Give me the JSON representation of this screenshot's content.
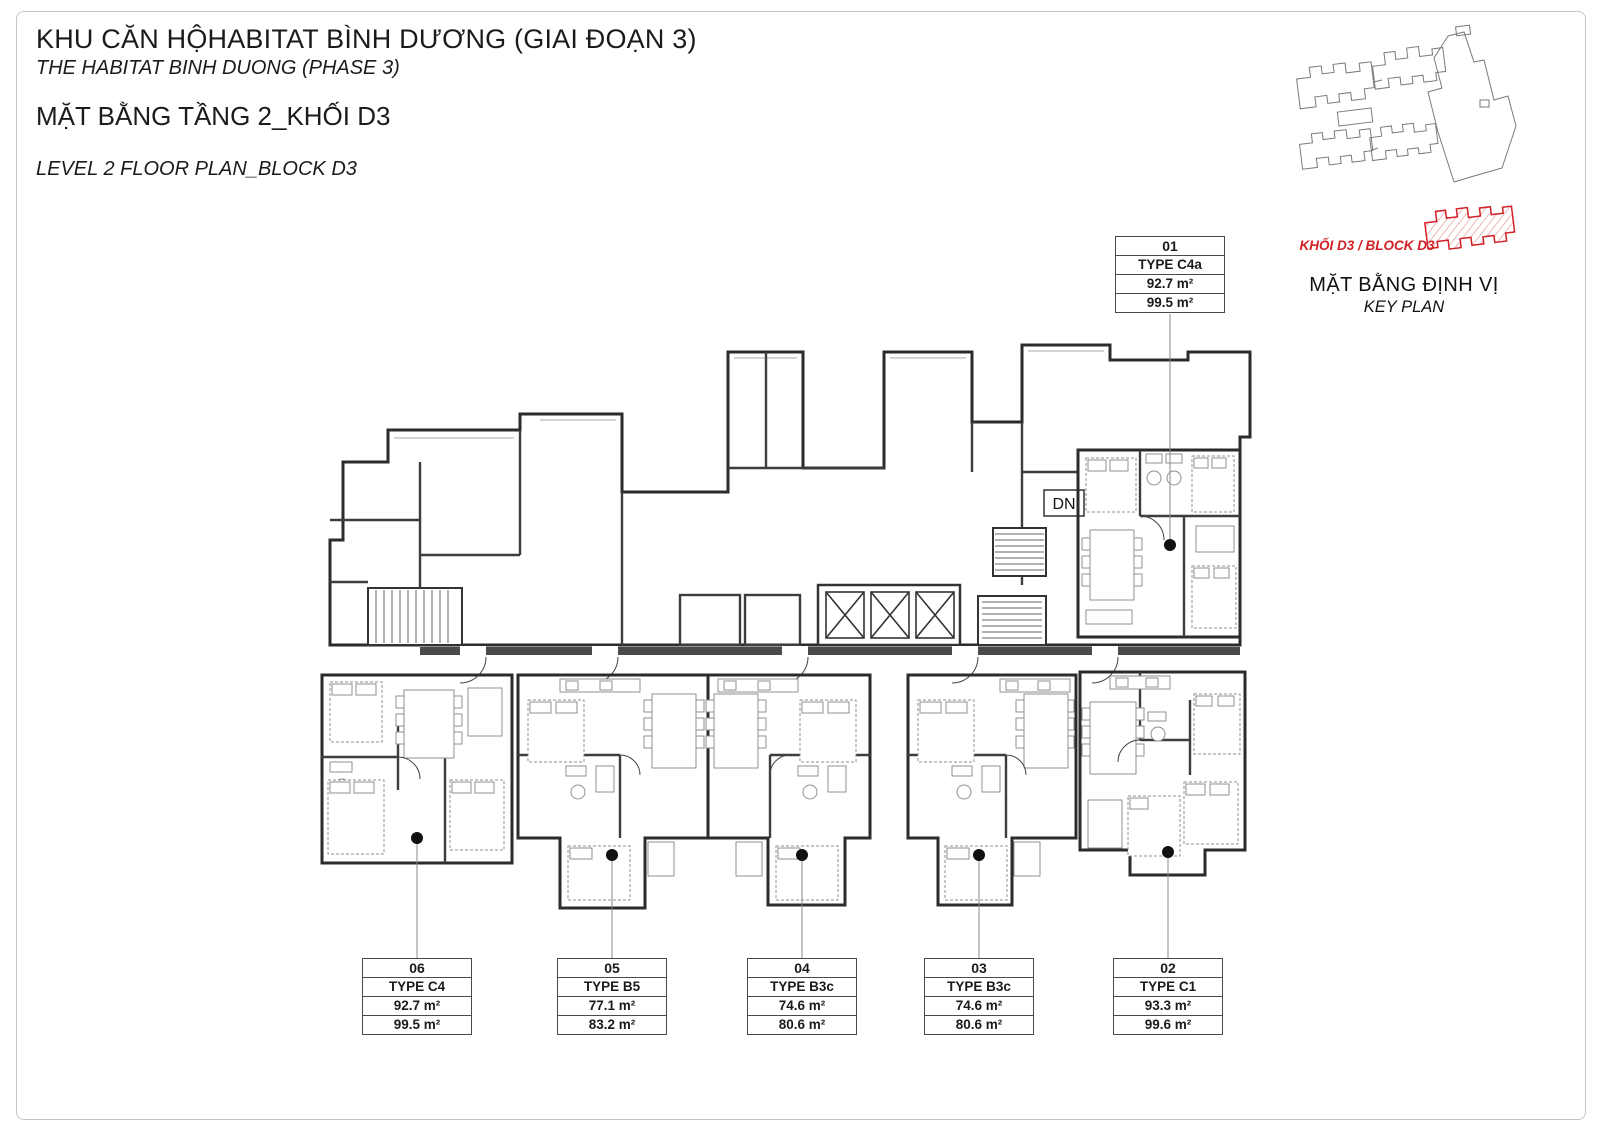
{
  "title": {
    "project_vi": "KHU CĂN HỘHABITAT BÌNH DƯƠNG (GIAI ĐOẠN 3)",
    "project_en": "THE HABITAT BINH DUONG (PHASE 3)",
    "plan_vi": "MẶT BẰNG TẦNG 2_KHỐI D3",
    "plan_en": "LEVEL 2 FLOOR PLAN_BLOCK D3"
  },
  "key_plan": {
    "block_label": "KHỐI D3 / BLOCK D3",
    "title_vi": "MẶT BẰNG ĐỊNH VỊ",
    "title_en": "KEY PLAN",
    "highlight_color": "#d22027"
  },
  "plan": {
    "dn_label": "DN"
  },
  "units": [
    {
      "number": "01",
      "type_label": "TYPE C4a",
      "area_1": "92.7 m²",
      "area_2": "99.5 m²",
      "color": "#7d4e7c"
    },
    {
      "number": "02",
      "type_label": "TYPE C1",
      "area_1": "93.3 m²",
      "area_2": "99.6 m²",
      "color": "#dec0db"
    },
    {
      "number": "03",
      "type_label": "TYPE B3c",
      "area_1": "74.6 m²",
      "area_2": "80.6 m²",
      "color": "#f5df7d"
    },
    {
      "number": "04",
      "type_label": "TYPE B3c",
      "area_1": "74.6 m²",
      "area_2": "80.6 m²",
      "color": "#f5df7d"
    },
    {
      "number": "05",
      "type_label": "TYPE B5",
      "area_1": "77.1 m²",
      "area_2": "83.2 m²",
      "color": "#f1cd4e"
    },
    {
      "number": "06",
      "type_label": "TYPE C4",
      "area_1": "92.7 m²",
      "area_2": "99.5 m²",
      "color": "#9c689c"
    }
  ]
}
